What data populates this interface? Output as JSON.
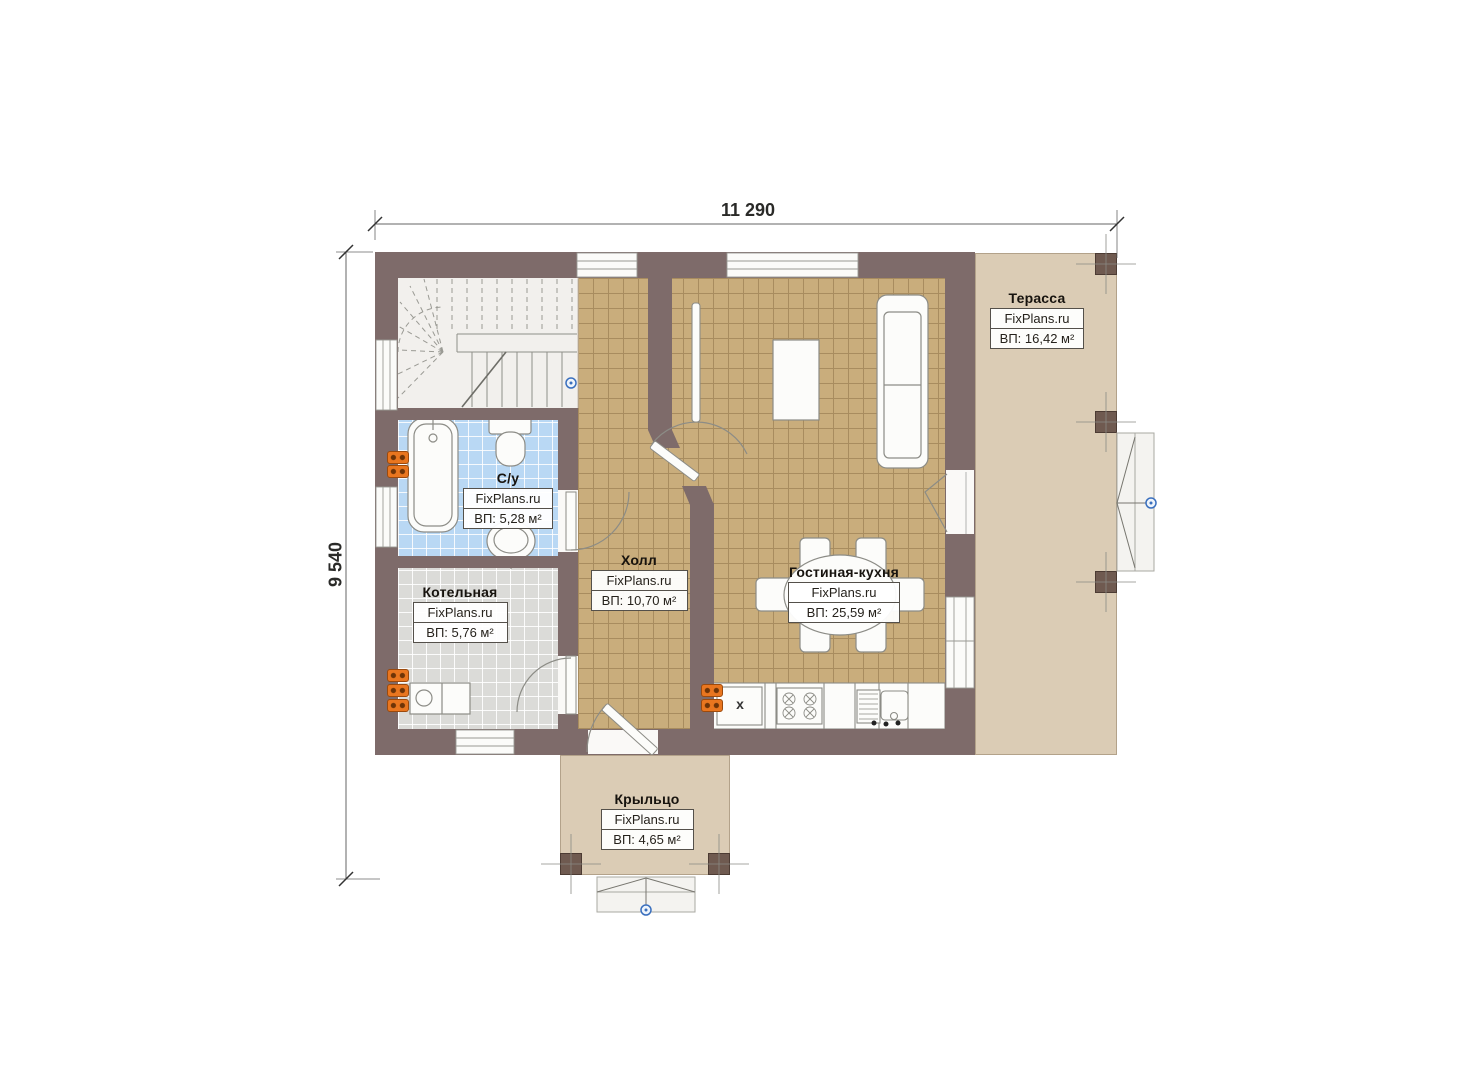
{
  "dims": {
    "width": "11 290",
    "height": "9 540"
  },
  "rooms": {
    "terrace": {
      "name": "Терасса",
      "brand": "FixPlans.ru",
      "area": "ВП: 16,42 м²"
    },
    "bathroom": {
      "name": "С/у",
      "brand": "FixPlans.ru",
      "area": "ВП: 5,28 м²"
    },
    "boiler": {
      "name": "Котельная",
      "brand": "FixPlans.ru",
      "area": "ВП: 5,76 м²"
    },
    "hall": {
      "name": "Холл",
      "brand": "FixPlans.ru",
      "area": "ВП: 10,70 м²"
    },
    "living": {
      "name": "Гостиная-кухня",
      "brand": "FixPlans.ru",
      "area": "ВП: 25,59 м²"
    },
    "porch": {
      "name": "Крыльцо",
      "brand": "FixPlans.ru",
      "area": "ВП: 4,65 м²"
    }
  },
  "kitchen": {
    "cabinet_mark": "x"
  },
  "colors": {
    "wall": "#7e6b6a",
    "pillar": "#6f5a50",
    "tile_tan": "#c9ad7c",
    "tile_blue": "#b9d8f4",
    "tile_gray": "#dbdbd8",
    "outdoor_fill": "#dbccb5",
    "radiator_orange": "#e9761f",
    "marker_blue": "#3a6fbe"
  }
}
